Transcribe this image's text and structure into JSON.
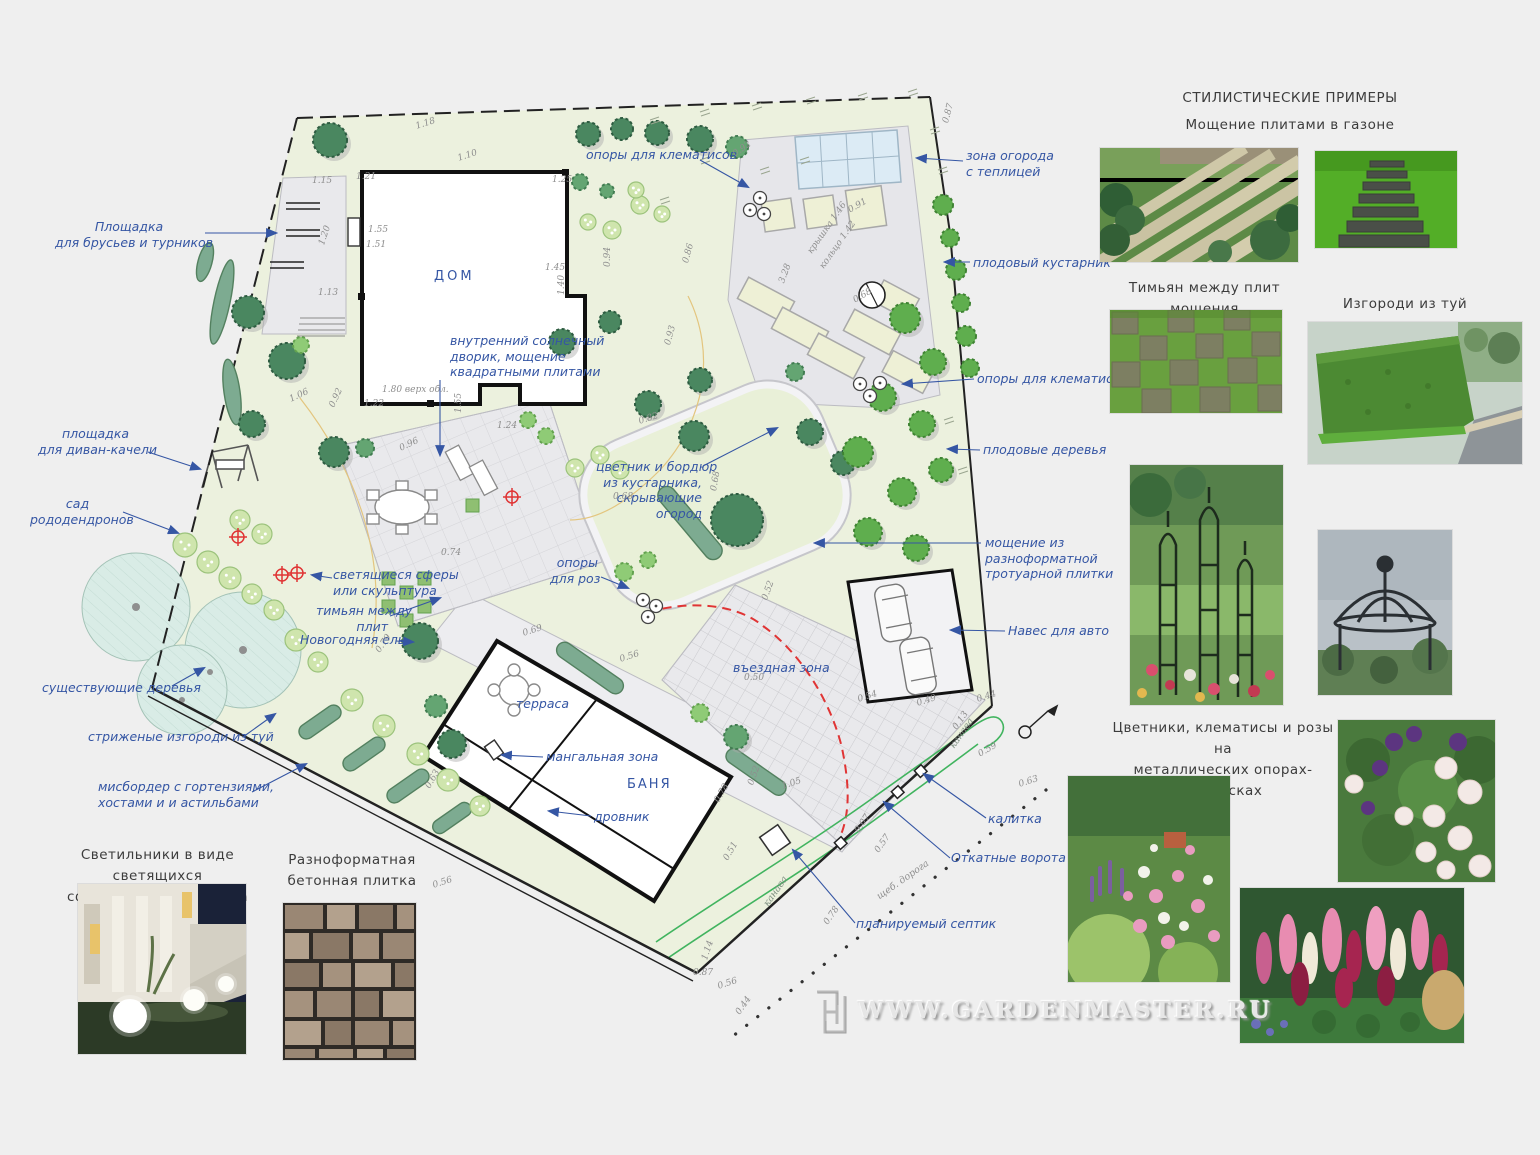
{
  "plan": {
    "house_label": "ДОМ",
    "banya_label": "БАНЯ",
    "terrace_label": "терраса",
    "entry_zone_label": "въездная зона",
    "callouts": {
      "bars": [
        "Площадка",
        "для брусьев и турников"
      ],
      "swing": [
        "площадка",
        "для диван-качели"
      ],
      "rhododendron": [
        "сад",
        "рододендронов"
      ],
      "existing_trees": [
        "существующие деревья"
      ],
      "thuja_hedges": [
        "стриженые изгороди из туй"
      ],
      "mixborder": [
        "мисбордер с гортензиями,",
        "хостами и  и астильбами"
      ],
      "courtyard": [
        "внутренний солнечный",
        "дворик, мощение",
        "квадратными плитами"
      ],
      "spheres": [
        "светящиеся сферы",
        "или скульптура"
      ],
      "thyme": [
        "тимьян между",
        "плит"
      ],
      "spruce": [
        "Новогодняя ель"
      ],
      "grill": [
        "мангальная зона"
      ],
      "woodshed": [
        "дровник"
      ],
      "clematis_top": [
        "опоры для клематисов"
      ],
      "greenhouse": [
        "зона огорода",
        "с теплицей"
      ],
      "fruit_bush": [
        "плодовый кустарник"
      ],
      "clematis_right": [
        "опоры для клематисов"
      ],
      "fruit_trees": [
        "плодовые деревья"
      ],
      "paving": [
        "мощение из",
        "разноформатной",
        "тротуарной плитки"
      ],
      "carport": [
        "Навес для авто"
      ],
      "flowerbed": [
        "цветник и бордюр",
        "из кустарника,",
        "скрывающие",
        "огород"
      ],
      "roses": [
        "опоры",
        "для роз"
      ],
      "gate": [
        "калитка"
      ],
      "sliding_gate": [
        "Откатные ворота"
      ],
      "septic": [
        "планируемый септик"
      ]
    },
    "line_labels": {
      "ditch1": "канава",
      "ditch2": "канава",
      "road": "щеб. дорога"
    },
    "elevation_marks": [
      {
        "t": "1.18",
        "x": 416,
        "y": 122,
        "r": -18
      },
      {
        "t": "1.10",
        "x": 458,
        "y": 154,
        "r": -18
      },
      {
        "t": "1.15",
        "x": 312,
        "y": 176,
        "r": 0
      },
      {
        "t": "1.21",
        "x": 356,
        "y": 172,
        "r": 0
      },
      {
        "t": "1.25",
        "x": 552,
        "y": 175,
        "r": 0
      },
      {
        "t": "1.55",
        "x": 368,
        "y": 225,
        "r": 0
      },
      {
        "t": "1.51",
        "x": 366,
        "y": 240,
        "r": 0
      },
      {
        "t": "1.20",
        "x": 322,
        "y": 240,
        "r": -72
      },
      {
        "t": "1.45",
        "x": 545,
        "y": 263,
        "r": 0
      },
      {
        "t": "1.40",
        "x": 562,
        "y": 290,
        "r": -90
      },
      {
        "t": "1.13",
        "x": 318,
        "y": 288,
        "r": 0
      },
      {
        "t": "0.92",
        "x": 734,
        "y": 150,
        "r": -35
      },
      {
        "t": "0.87",
        "x": 946,
        "y": 118,
        "r": -75
      },
      {
        "t": "0.91",
        "x": 849,
        "y": 206,
        "r": -30
      },
      {
        "t": "0.94",
        "x": 608,
        "y": 262,
        "r": -90
      },
      {
        "t": "0.86",
        "x": 686,
        "y": 258,
        "r": -75
      },
      {
        "t": "3.28",
        "x": 782,
        "y": 278,
        "r": -70
      },
      {
        "t": "крышка 1.46",
        "x": 810,
        "y": 248,
        "r": -55
      },
      {
        "t": "кольцо 1.42",
        "x": 822,
        "y": 263,
        "r": -55
      },
      {
        "t": "0.68",
        "x": 854,
        "y": 296,
        "r": -30
      },
      {
        "t": "1.06",
        "x": 290,
        "y": 395,
        "r": -25
      },
      {
        "t": "0.92",
        "x": 332,
        "y": 402,
        "r": -65
      },
      {
        "t": "1.80 верх обл.",
        "x": 382,
        "y": 385,
        "r": 0
      },
      {
        "t": "1.22",
        "x": 364,
        "y": 399,
        "r": 0
      },
      {
        "t": "1.55",
        "x": 459,
        "y": 408,
        "r": -90
      },
      {
        "t": "1.24",
        "x": 497,
        "y": 421,
        "r": 0
      },
      {
        "t": "0.93",
        "x": 668,
        "y": 340,
        "r": -75
      },
      {
        "t": "0.96",
        "x": 400,
        "y": 444,
        "r": -25
      },
      {
        "t": "0.82",
        "x": 639,
        "y": 417,
        "r": -18
      },
      {
        "t": "0.68",
        "x": 613,
        "y": 492,
        "r": 0
      },
      {
        "t": "0.68",
        "x": 714,
        "y": 486,
        "r": -80
      },
      {
        "t": "0.74",
        "x": 441,
        "y": 548,
        "r": 0
      },
      {
        "t": "0.52",
        "x": 765,
        "y": 595,
        "r": -70
      },
      {
        "t": "0.69",
        "x": 523,
        "y": 629,
        "r": -18
      },
      {
        "t": "0.79",
        "x": 378,
        "y": 647,
        "r": -55
      },
      {
        "t": "0.50",
        "x": 744,
        "y": 673,
        "r": 0
      },
      {
        "t": "0.56",
        "x": 620,
        "y": 655,
        "r": -18
      },
      {
        "t": "0.63",
        "x": 428,
        "y": 783,
        "r": -60
      },
      {
        "t": "1.05",
        "x": 782,
        "y": 782,
        "r": -18
      },
      {
        "t": "0.78",
        "x": 717,
        "y": 797,
        "r": -60
      },
      {
        "t": "0.56",
        "x": 433,
        "y": 881,
        "r": -18
      },
      {
        "t": "0.51",
        "x": 726,
        "y": 855,
        "r": -60
      },
      {
        "t": "0.52",
        "x": 751,
        "y": 780,
        "r": -70
      },
      {
        "t": "0.54",
        "x": 858,
        "y": 695,
        "r": -18
      },
      {
        "t": "0.49",
        "x": 917,
        "y": 699,
        "r": -18
      },
      {
        "t": "0.44",
        "x": 977,
        "y": 695,
        "r": -18
      },
      {
        "t": "0.13",
        "x": 955,
        "y": 724,
        "r": -55
      },
      {
        "t": "0.59",
        "x": 979,
        "y": 750,
        "r": -30
      },
      {
        "t": "0.63",
        "x": 1019,
        "y": 780,
        "r": -18
      },
      {
        "t": "0.07",
        "x": 857,
        "y": 827,
        "r": -55
      },
      {
        "t": "0.57",
        "x": 877,
        "y": 847,
        "r": -55
      },
      {
        "t": "0.78",
        "x": 826,
        "y": 919,
        "r": -55
      },
      {
        "t": "1.14",
        "x": 705,
        "y": 955,
        "r": -72
      },
      {
        "t": "0.87",
        "x": 693,
        "y": 968,
        "r": 0
      },
      {
        "t": "0.56",
        "x": 718,
        "y": 982,
        "r": -18
      },
      {
        "t": "0.44",
        "x": 738,
        "y": 1009,
        "r": -55
      }
    ]
  },
  "examples": {
    "title": "СТИЛИСТИЧЕСКИЕ ПРИМЕРЫ",
    "captions": {
      "paving_lawn": "Мощение плитами в газоне",
      "thyme": "Тимьян между плит мощения",
      "thuja": "Изгороди из туй",
      "obelisks": [
        "Цветники, клематисы и розы на",
        "металлических опорах-обелисках"
      ]
    }
  },
  "bottom_examples": {
    "lamps": [
      "Светильники в виде светящихся",
      "сфер разного диаметра"
    ],
    "tiles": [
      "Разноформатная",
      "бетонная плитка"
    ]
  },
  "watermark": "WWW.GARDENMASTER.RU",
  "colors": {
    "label_blue": "#3556a4",
    "lawn_green": "#ecf1de",
    "accent_red": "#e03434",
    "ditch_green": "#41b45f"
  }
}
